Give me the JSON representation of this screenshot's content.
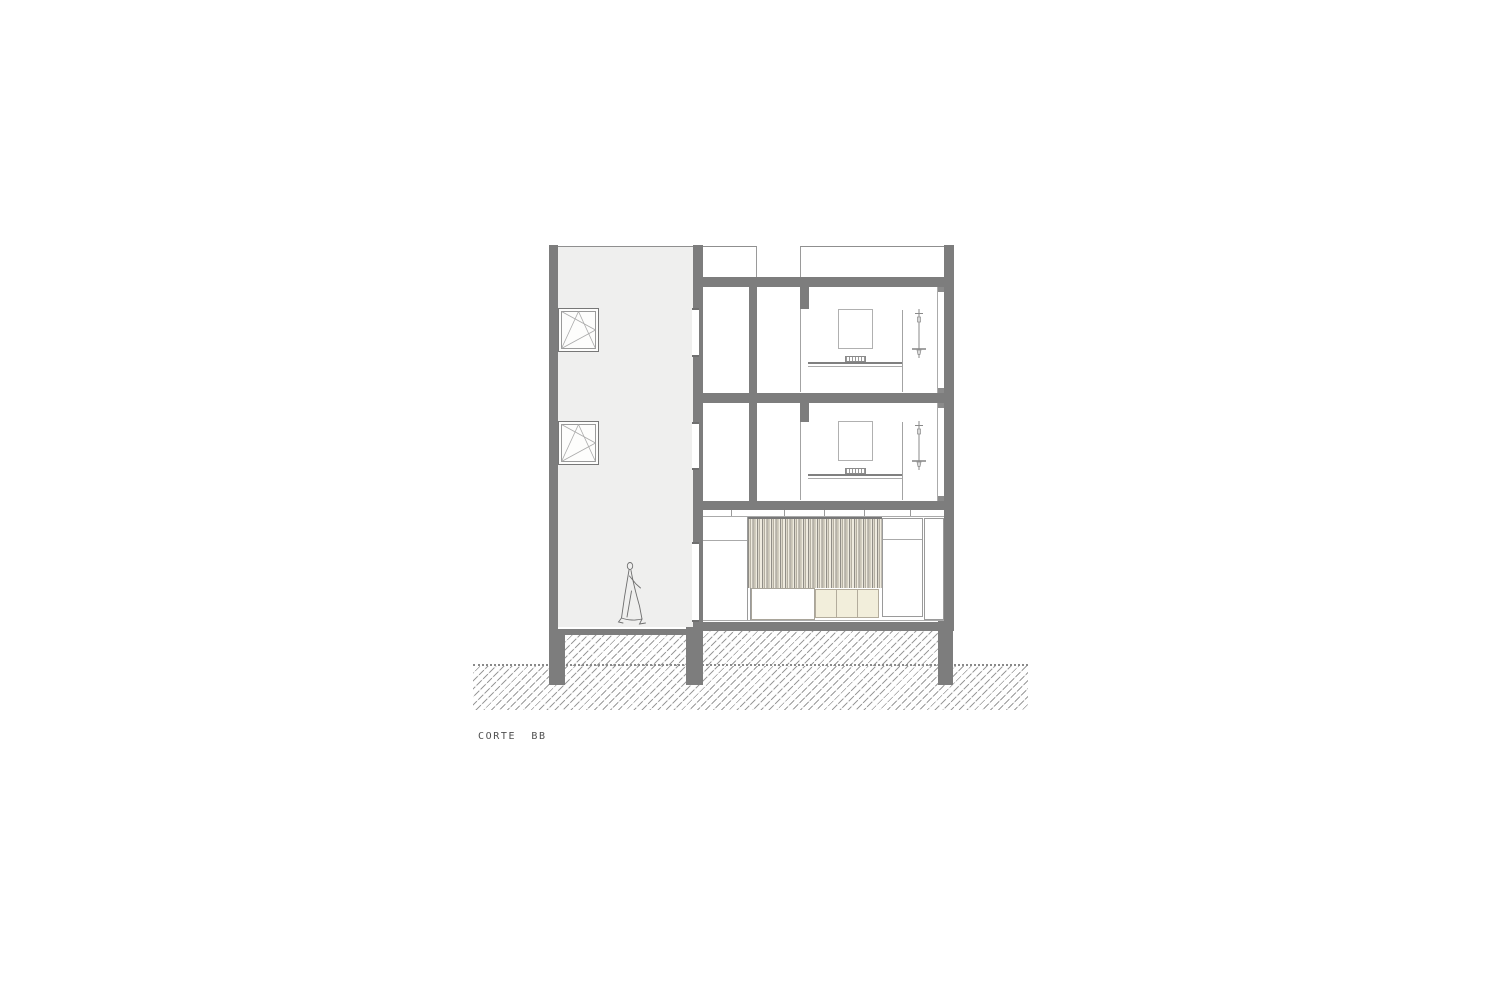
{
  "sheet": {
    "label": "CORTE  BB",
    "drawing_type": "building cross-section (architectural)"
  },
  "colors": {
    "cut_wall_gray": "#7d7d7d",
    "tower_interior_fill": "#efefee",
    "outline_gray": "#9a9a9a",
    "cream_cabinet": "#f2eedb",
    "curtain_tones": [
      "#908d86",
      "#ddd8cb",
      "#b5b0a2",
      "#efebdf"
    ],
    "ground_hatch_line": "#9b9b9b",
    "label_text": "#4f4f4f",
    "background": "#ffffff"
  },
  "drawing": {
    "left_tower": {
      "description": "tall stair/patio volume",
      "elements": [
        "tilt-turn-window-symbol-upper",
        "tilt-turn-window-symbol-lower",
        "walking-person-figure"
      ]
    },
    "right_building": {
      "stories": [
        {
          "level": "third-floor",
          "elements": [
            "room-a",
            "room-b",
            "door-opening",
            "wall-picture",
            "desk-surface",
            "desk-grille",
            "shower-partition",
            "shower-fixture-symbol",
            "facade-window-strip",
            "courtyard-window-marker"
          ]
        },
        {
          "level": "second-floor",
          "elements": [
            "room-a",
            "room-b",
            "door-opening",
            "wall-picture",
            "desk-surface",
            "desk-grille",
            "shower-partition",
            "shower-fixture-symbol",
            "facade-window-strip",
            "courtyard-window-marker"
          ]
        },
        {
          "level": "ground-floor",
          "elements": [
            "transom-band",
            "striped-curtain",
            "white-counter-cabinet",
            "cream-cabinet-1",
            "cream-cabinet-2",
            "cream-cabinet-3",
            "tall-unit",
            "side-unit",
            "courtyard-window-marker"
          ]
        }
      ],
      "parapets": 2
    },
    "ground": {
      "elements": [
        "earth-hatch",
        "grade-dotted-line",
        "foundation-pier-left",
        "foundation-pier-middle",
        "foundation-pier-right"
      ]
    }
  }
}
